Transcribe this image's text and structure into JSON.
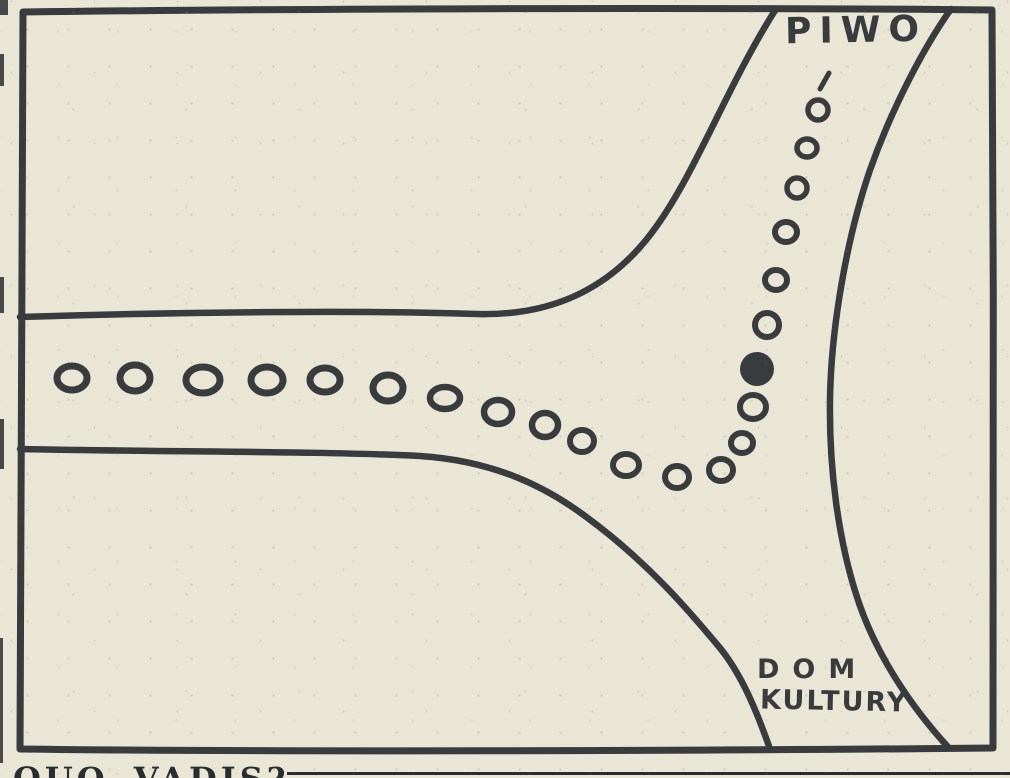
{
  "colors": {
    "paper": "#e9e6d5",
    "ink": "#383c3f",
    "caption_ink": "#282d32"
  },
  "labels": {
    "destination_top": "PIWO",
    "destination_bottom_line1": "DOM",
    "destination_bottom_line2": "KULTURY"
  },
  "caption": {
    "text": "QUO VADIS?"
  },
  "trail": {
    "description": "footprint trail from left road turning up toward PIWO",
    "footprints": [
      {
        "x": 72,
        "y": 378,
        "rx": 15,
        "ry": 12,
        "sw": 7,
        "type": "open"
      },
      {
        "x": 135,
        "y": 378,
        "rx": 15,
        "ry": 13,
        "sw": 7,
        "type": "open"
      },
      {
        "x": 203,
        "y": 380,
        "rx": 17,
        "ry": 13,
        "sw": 7,
        "type": "open"
      },
      {
        "x": 267,
        "y": 380,
        "rx": 16,
        "ry": 13,
        "sw": 7,
        "type": "open"
      },
      {
        "x": 325,
        "y": 380,
        "rx": 15,
        "ry": 12,
        "sw": 7,
        "type": "open"
      },
      {
        "x": 388,
        "y": 388,
        "rx": 15,
        "ry": 13,
        "sw": 7,
        "type": "open"
      },
      {
        "x": 445,
        "y": 398,
        "rx": 15,
        "ry": 11,
        "sw": 6.5,
        "type": "open"
      },
      {
        "x": 498,
        "y": 412,
        "rx": 14,
        "ry": 12,
        "sw": 6.5,
        "type": "open"
      },
      {
        "x": 545,
        "y": 425,
        "rx": 13,
        "ry": 12,
        "sw": 6.5,
        "type": "open"
      },
      {
        "x": 582,
        "y": 441,
        "rx": 12,
        "ry": 11,
        "sw": 6,
        "type": "open"
      },
      {
        "x": 626,
        "y": 465,
        "rx": 13,
        "ry": 11,
        "sw": 6,
        "type": "open"
      },
      {
        "x": 677,
        "y": 477,
        "rx": 12,
        "ry": 11,
        "sw": 6,
        "type": "open"
      },
      {
        "x": 721,
        "y": 470,
        "rx": 12,
        "ry": 11,
        "sw": 6,
        "type": "open"
      },
      {
        "x": 742,
        "y": 443,
        "rx": 11,
        "ry": 10,
        "sw": 6,
        "type": "open"
      },
      {
        "x": 753,
        "y": 407,
        "rx": 13,
        "ry": 12,
        "sw": 6,
        "type": "open"
      },
      {
        "x": 757,
        "y": 369,
        "rx": 17,
        "ry": 17,
        "sw": 0,
        "type": "filled"
      },
      {
        "x": 767,
        "y": 325,
        "rx": 12,
        "ry": 12,
        "sw": 6,
        "type": "open"
      },
      {
        "x": 776,
        "y": 280,
        "rx": 11,
        "ry": 10,
        "sw": 6,
        "type": "open"
      },
      {
        "x": 786,
        "y": 232,
        "rx": 11,
        "ry": 10,
        "sw": 6,
        "type": "open"
      },
      {
        "x": 797,
        "y": 188,
        "rx": 10,
        "ry": 10,
        "sw": 5.5,
        "type": "open"
      },
      {
        "x": 807,
        "y": 148,
        "rx": 10,
        "ry": 9,
        "sw": 5.5,
        "type": "open"
      },
      {
        "x": 818,
        "y": 110,
        "rx": 10,
        "ry": 10,
        "sw": 5.5,
        "type": "open"
      }
    ],
    "fade_tick": {
      "x1": 829,
      "y1": 73,
      "x2": 820,
      "y2": 89
    }
  }
}
